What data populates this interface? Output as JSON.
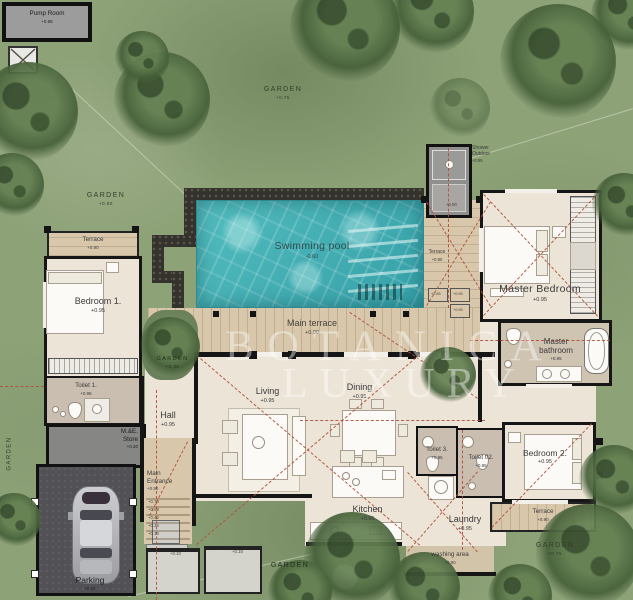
{
  "watermark": {
    "line1": "BOTANICA",
    "line2": "LUXURY"
  },
  "rooms": {
    "pump_room": {
      "label": "Pump Room",
      "level": "+0.95"
    },
    "swimming_pool": {
      "label": "Swimming pool",
      "level": "-0.60"
    },
    "main_terrace": {
      "label": "Main terrace",
      "level": "+0.90"
    },
    "pool_terrace": {
      "label": "Terrace",
      "level": "+0.90"
    },
    "outdoor_shower": {
      "label": "Shower Outdoor",
      "level": "+0.95",
      "step_level": "+0.90"
    },
    "master_bedroom": {
      "label": "Master Bedroom",
      "level": "+0.95"
    },
    "master_bathroom": {
      "label_line1": "Master",
      "label_line2": "bathroom",
      "level": "+0.95"
    },
    "bedroom1": {
      "label": "Bedroom 1.",
      "level": "+0.95"
    },
    "bedroom1_terrace": {
      "label": "Terrace",
      "level": "+0.90"
    },
    "toilet1": {
      "label": "Toilet 1.",
      "level": "+0.95"
    },
    "me_store": {
      "label_line1": "M.&E.",
      "label_line2": "Store",
      "level": "+0.20"
    },
    "hall": {
      "label": "Hall",
      "level": "+0.95"
    },
    "main_entrance": {
      "label_line1": "Main",
      "label_line2": "Entrance",
      "level": "+0.90"
    },
    "living": {
      "label": "Living",
      "level": "+0.95"
    },
    "dining": {
      "label": "Dining",
      "level": "+0.95"
    },
    "kitchen": {
      "label": "Kitchen",
      "level": "+0.95"
    },
    "toilet3": {
      "label": "Toilet 3.",
      "level": "+0.95"
    },
    "toilet02": {
      "label": "Toilet 02.",
      "level": "+0.95"
    },
    "laundry": {
      "label": "Laundry",
      "level": "+0.95"
    },
    "washing_area": {
      "label": "washing area",
      "level": "+0.90"
    },
    "bedroom2": {
      "label": "Bedroom 2.",
      "level": "+0.95"
    },
    "bedroom2_terrace": {
      "label": "Terrace",
      "level": "+0.90"
    },
    "parking": {
      "label": "Parking",
      "level": "+0.15"
    }
  },
  "gardens": {
    "top": {
      "label": "GARDEN",
      "level": "+0.75"
    },
    "left": {
      "label": "GARDEN",
      "level": "+0.80"
    },
    "left_edge": {
      "label": "GARDEN"
    },
    "courtyard": {
      "label": "GARDEN",
      "level": "+0.30"
    },
    "bottom_center": {
      "label": "GARDEN"
    },
    "bottom_right": {
      "label": "GARDEN",
      "level": "+0.75"
    }
  },
  "levels": {
    "entrance_steps": [
      "+0.74",
      "+0.58",
      "+0.42",
      "+0.26",
      "+0.10"
    ],
    "stepping_stones": [
      "+0.10",
      "+0.10"
    ],
    "terrace_steps": [
      "+0.85",
      "+0.95",
      "+0.95"
    ]
  },
  "colors": {
    "pool_water": "#43b1b4",
    "terrace": "#d8c7ab",
    "floor": "#ece4d6",
    "wall": "#161616",
    "garden": "#8ea278",
    "dashed_line": "#b0503a",
    "parking": "#4c4c4f"
  }
}
